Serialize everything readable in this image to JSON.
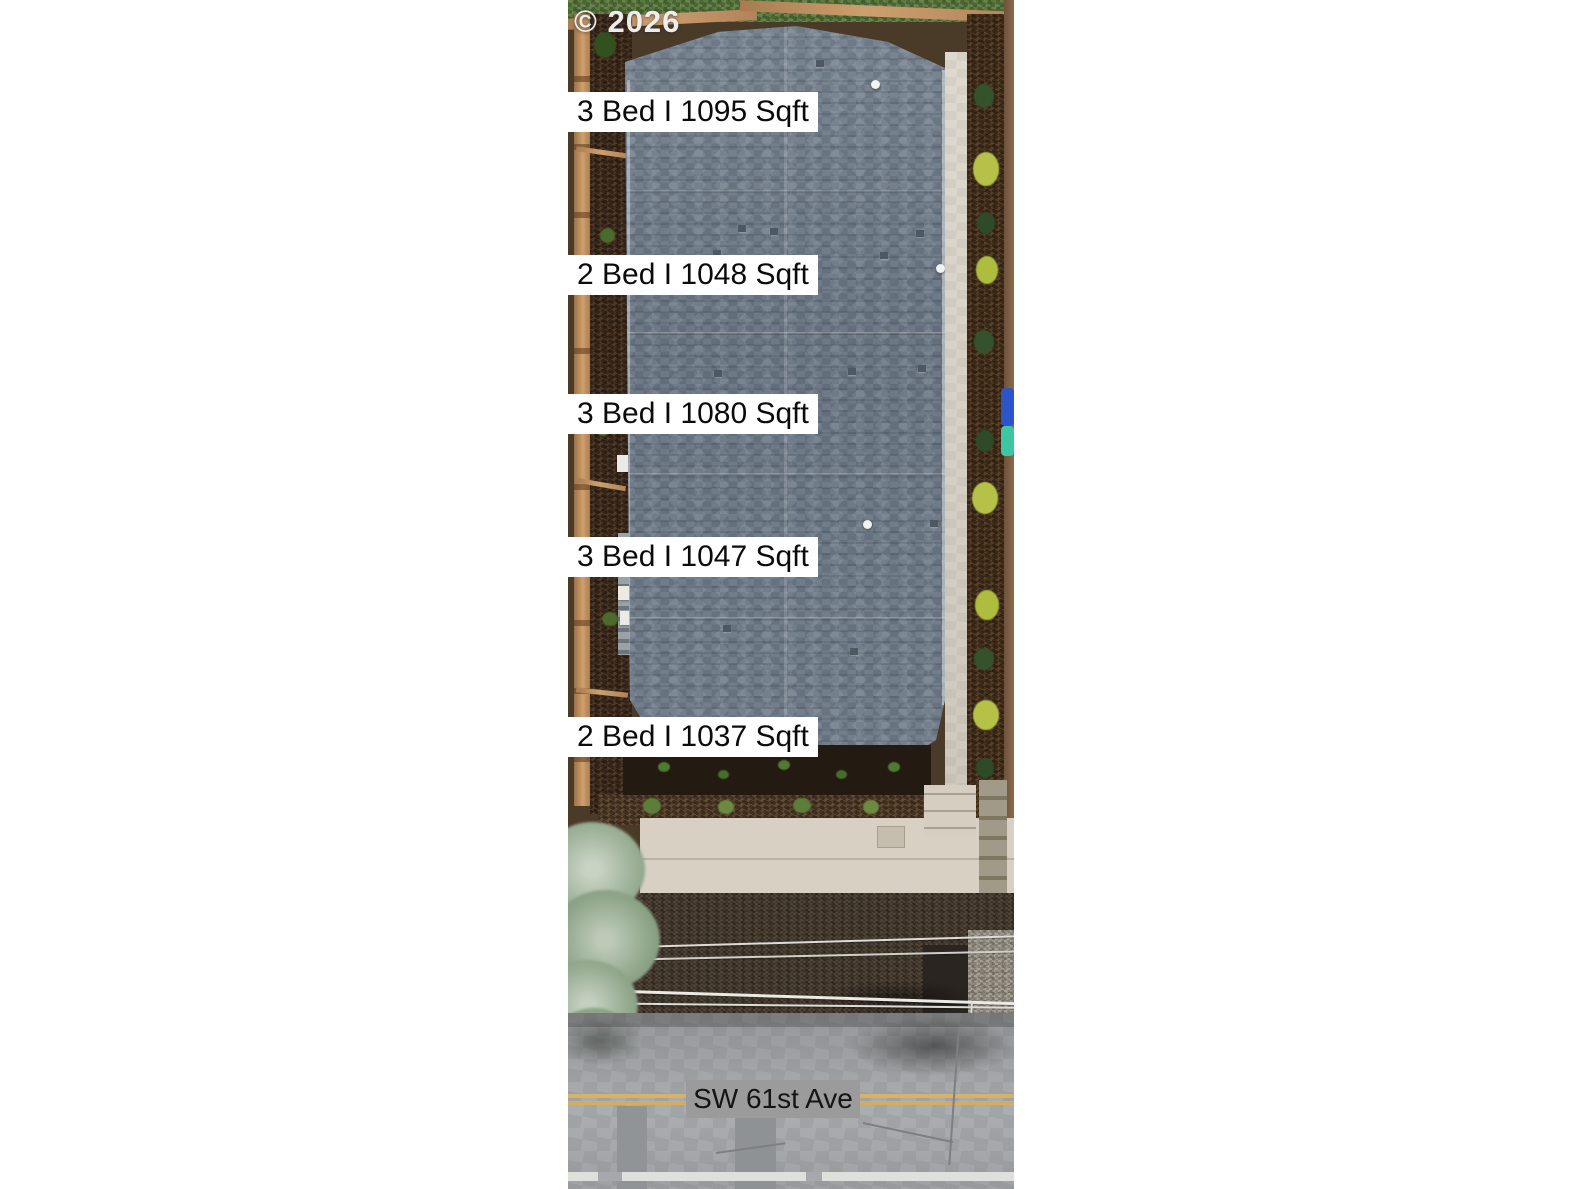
{
  "watermark": {
    "text": "© 2026"
  },
  "units": [
    {
      "line1": "11078 #5",
      "line2": "3 Bed I 1095 Sqft",
      "address": "11078",
      "unit": "#5",
      "beds": 3,
      "sqft": 1095
    },
    {
      "line1": "11076 #4",
      "line2": "2 Bed I 1048 Sqft",
      "address": "11076",
      "unit": "#4",
      "beds": 2,
      "sqft": 1048
    },
    {
      "line1": "11074 #3",
      "line2": "3 Bed I 1080 Sqft",
      "address": "11074",
      "unit": "#3",
      "beds": 3,
      "sqft": 1080
    },
    {
      "line1": "11072 #2",
      "line2": "3 Bed I 1047 Sqft",
      "address": "11072",
      "unit": "#2",
      "beds": 3,
      "sqft": 1047
    },
    {
      "line1": "11070 #1",
      "line2": "2 Bed I 1037 Sqft",
      "address": "11070",
      "unit": "#1",
      "beds": 2,
      "sqft": 1037
    }
  ],
  "street": {
    "label": "SW 61st Ave"
  },
  "colors": {
    "page_background": "#ffffff",
    "label_background": "#ffffff",
    "label_text": "#0b0b0b",
    "street_label_background": "#9b9b9b",
    "roof_shingle": "#75818e",
    "road_asphalt": "#a6a9ab",
    "center_line_yellow": "#d9b267",
    "mulch_brown": "#3e2c1e",
    "fence_wood": "#c69a6a",
    "grass_green": "#5a7a3c",
    "concrete_beige": "#d7d0c3"
  }
}
